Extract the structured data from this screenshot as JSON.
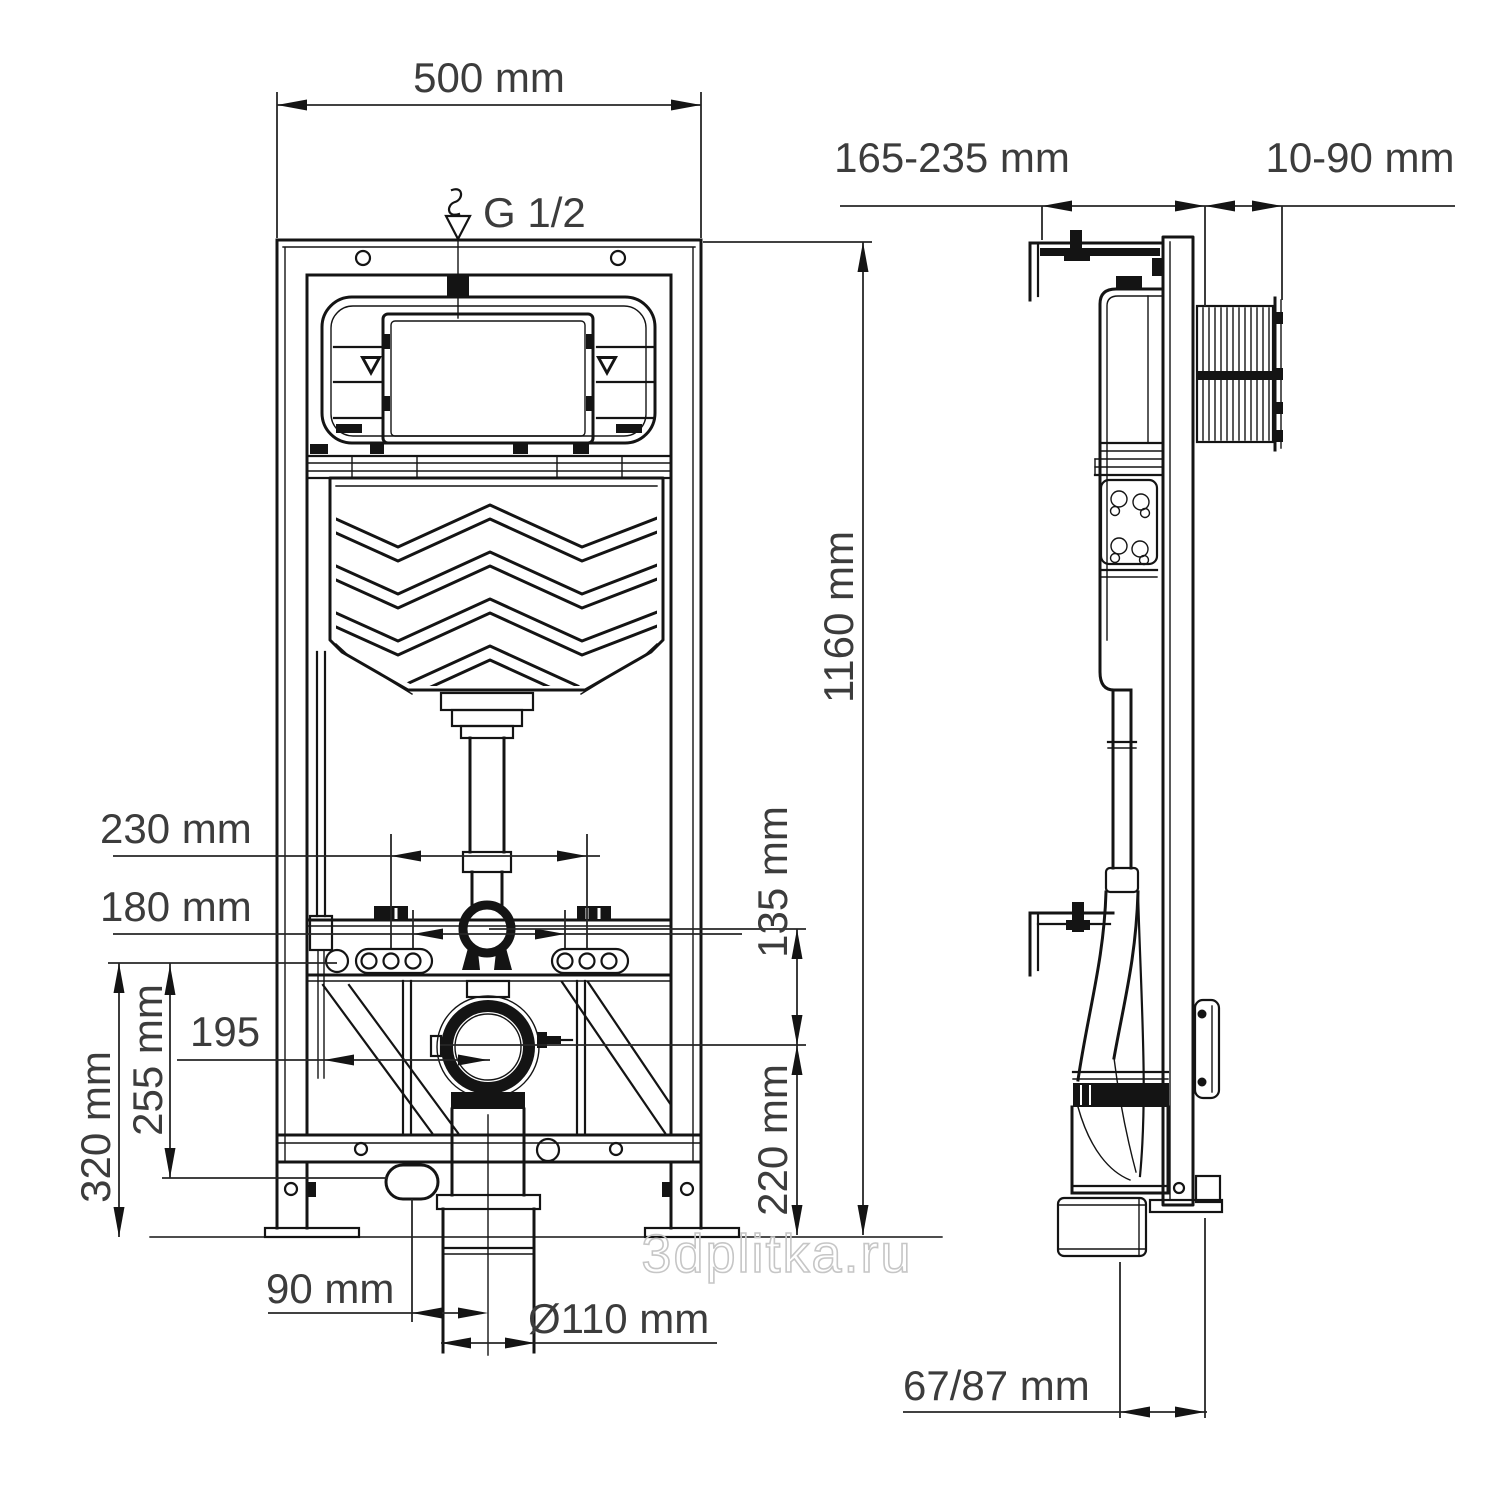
{
  "page": {
    "background": "#ffffff",
    "type": "technical dimensional drawing",
    "subject": "Concealed cistern installation frame for wall-hung WC, front and side elevations"
  },
  "colors": {
    "line": "#141414",
    "dimension_text": "#3c3c3c",
    "watermark": "#c6c6c6"
  },
  "watermark": "3dplitka.ru",
  "views": {
    "front": {
      "name": "front elevation"
    },
    "side": {
      "name": "side elevation"
    }
  },
  "dimensions": {
    "frame_width": {
      "label": "500 mm",
      "orientation": "horizontal",
      "view": "front"
    },
    "water_inlet": {
      "label": "G 1/2",
      "orientation": "label",
      "view": "front"
    },
    "frame_height": {
      "label": "1160 mm",
      "orientation": "vertical",
      "view": "front"
    },
    "anchor_span_outer": {
      "label": "230 mm",
      "orientation": "horizontal",
      "view": "front"
    },
    "anchor_span_inner": {
      "label": "180 mm",
      "orientation": "horizontal",
      "view": "front"
    },
    "flush_to_outlet": {
      "label": "135 mm",
      "orientation": "vertical",
      "view": "front"
    },
    "outlet_height": {
      "label": "220 mm",
      "orientation": "vertical",
      "view": "front"
    },
    "supply_height": {
      "label": "320 mm",
      "orientation": "vertical",
      "view": "front"
    },
    "trap_height": {
      "label": "255 mm",
      "orientation": "vertical",
      "view": "front"
    },
    "supply_offset": {
      "label": "195",
      "orientation": "horizontal",
      "view": "front"
    },
    "drain_offset": {
      "label": "90 mm",
      "orientation": "horizontal",
      "view": "front"
    },
    "drain_diameter": {
      "label": "Ø110 mm",
      "orientation": "horizontal",
      "view": "front"
    },
    "wall_distance": {
      "label": "165-235 mm",
      "orientation": "horizontal",
      "view": "side"
    },
    "plate_depth": {
      "label": "10-90 mm",
      "orientation": "horizontal",
      "view": "side"
    },
    "outlet_depth": {
      "label": "67/87 mm",
      "orientation": "horizontal",
      "view": "side"
    }
  }
}
